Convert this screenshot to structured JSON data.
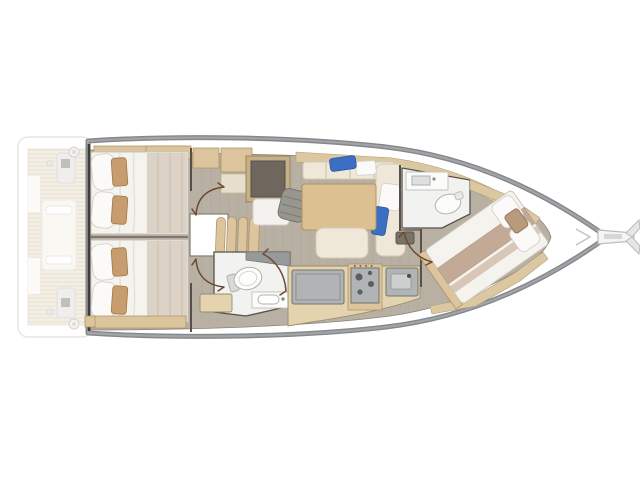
{
  "diagram": {
    "kind": "sailing-yacht-interior-floor-plan",
    "view": "top-down",
    "orientation": {
      "bow": "right",
      "stern": "left"
    },
    "areas": [
      {
        "id": "swim-platform-cockpit",
        "features": [
          "teak-sole",
          "cockpit-table",
          "helm-pod-port",
          "helm-pod-starboard",
          "winch-port",
          "winch-starboard"
        ]
      },
      {
        "id": "aft-cabin-port",
        "features": [
          "double-bed",
          "two-pillows",
          "two-accent-cushions",
          "headboard-shelf"
        ]
      },
      {
        "id": "aft-cabin-starboard",
        "features": [
          "double-bed",
          "two-pillows",
          "two-accent-cushions",
          "foot-bench"
        ]
      },
      {
        "id": "companionway",
        "features": [
          "four-steps",
          "landing",
          "cabin-door-port",
          "cabin-door-starboard"
        ]
      },
      {
        "id": "nav-station",
        "features": [
          "chart-table",
          "swivel-seat",
          "cabinets",
          "desk-return"
        ]
      },
      {
        "id": "salon",
        "features": [
          "settee",
          "chaise",
          "dining-table",
          "bench",
          "blue-throw-pillows",
          "hull-shelf"
        ]
      },
      {
        "id": "head-midship",
        "features": [
          "toilet",
          "vanity-sink",
          "entry-step",
          "door-swing"
        ]
      },
      {
        "id": "galley",
        "features": [
          "refrigerator-counter",
          "stove-with-burners",
          "sink",
          "counter"
        ]
      },
      {
        "id": "head-forward",
        "features": [
          "vanity-sink",
          "toilet",
          "door-swing"
        ]
      },
      {
        "id": "cabin-forward",
        "features": [
          "island-double-bed",
          "bed-runner",
          "pillows",
          "hull-shelves",
          "foot-step"
        ]
      },
      {
        "id": "bow",
        "features": [
          "bowsprit",
          "anchor",
          "bow-locker-chevron"
        ]
      }
    ]
  },
  "colors": {
    "paper": "#ffffff",
    "hull_band": "#84878b",
    "hull_band_light": "#a2a4a7",
    "floor": "#b9b0a4",
    "floor_edge": "#8a8478",
    "wood": "#dcc49c",
    "wood_light": "#e3d3ae",
    "shelf": "#dbc8a2",
    "bed": "#f5f3ee",
    "blanket": "#dcd3c6",
    "pillow": "#fbfaf8",
    "cushion_tan": "#c79d6f",
    "cream": "#efe8d8",
    "accent_blue": "#3a6fc4",
    "chart_table": "#6f675d",
    "seat_gray": "#97968f",
    "appliance": "#b0b4b4",
    "head_floor": "#f2f3f1",
    "wall": "#57504a",
    "door": "#6b4a33",
    "teak": "#ece2cf"
  }
}
